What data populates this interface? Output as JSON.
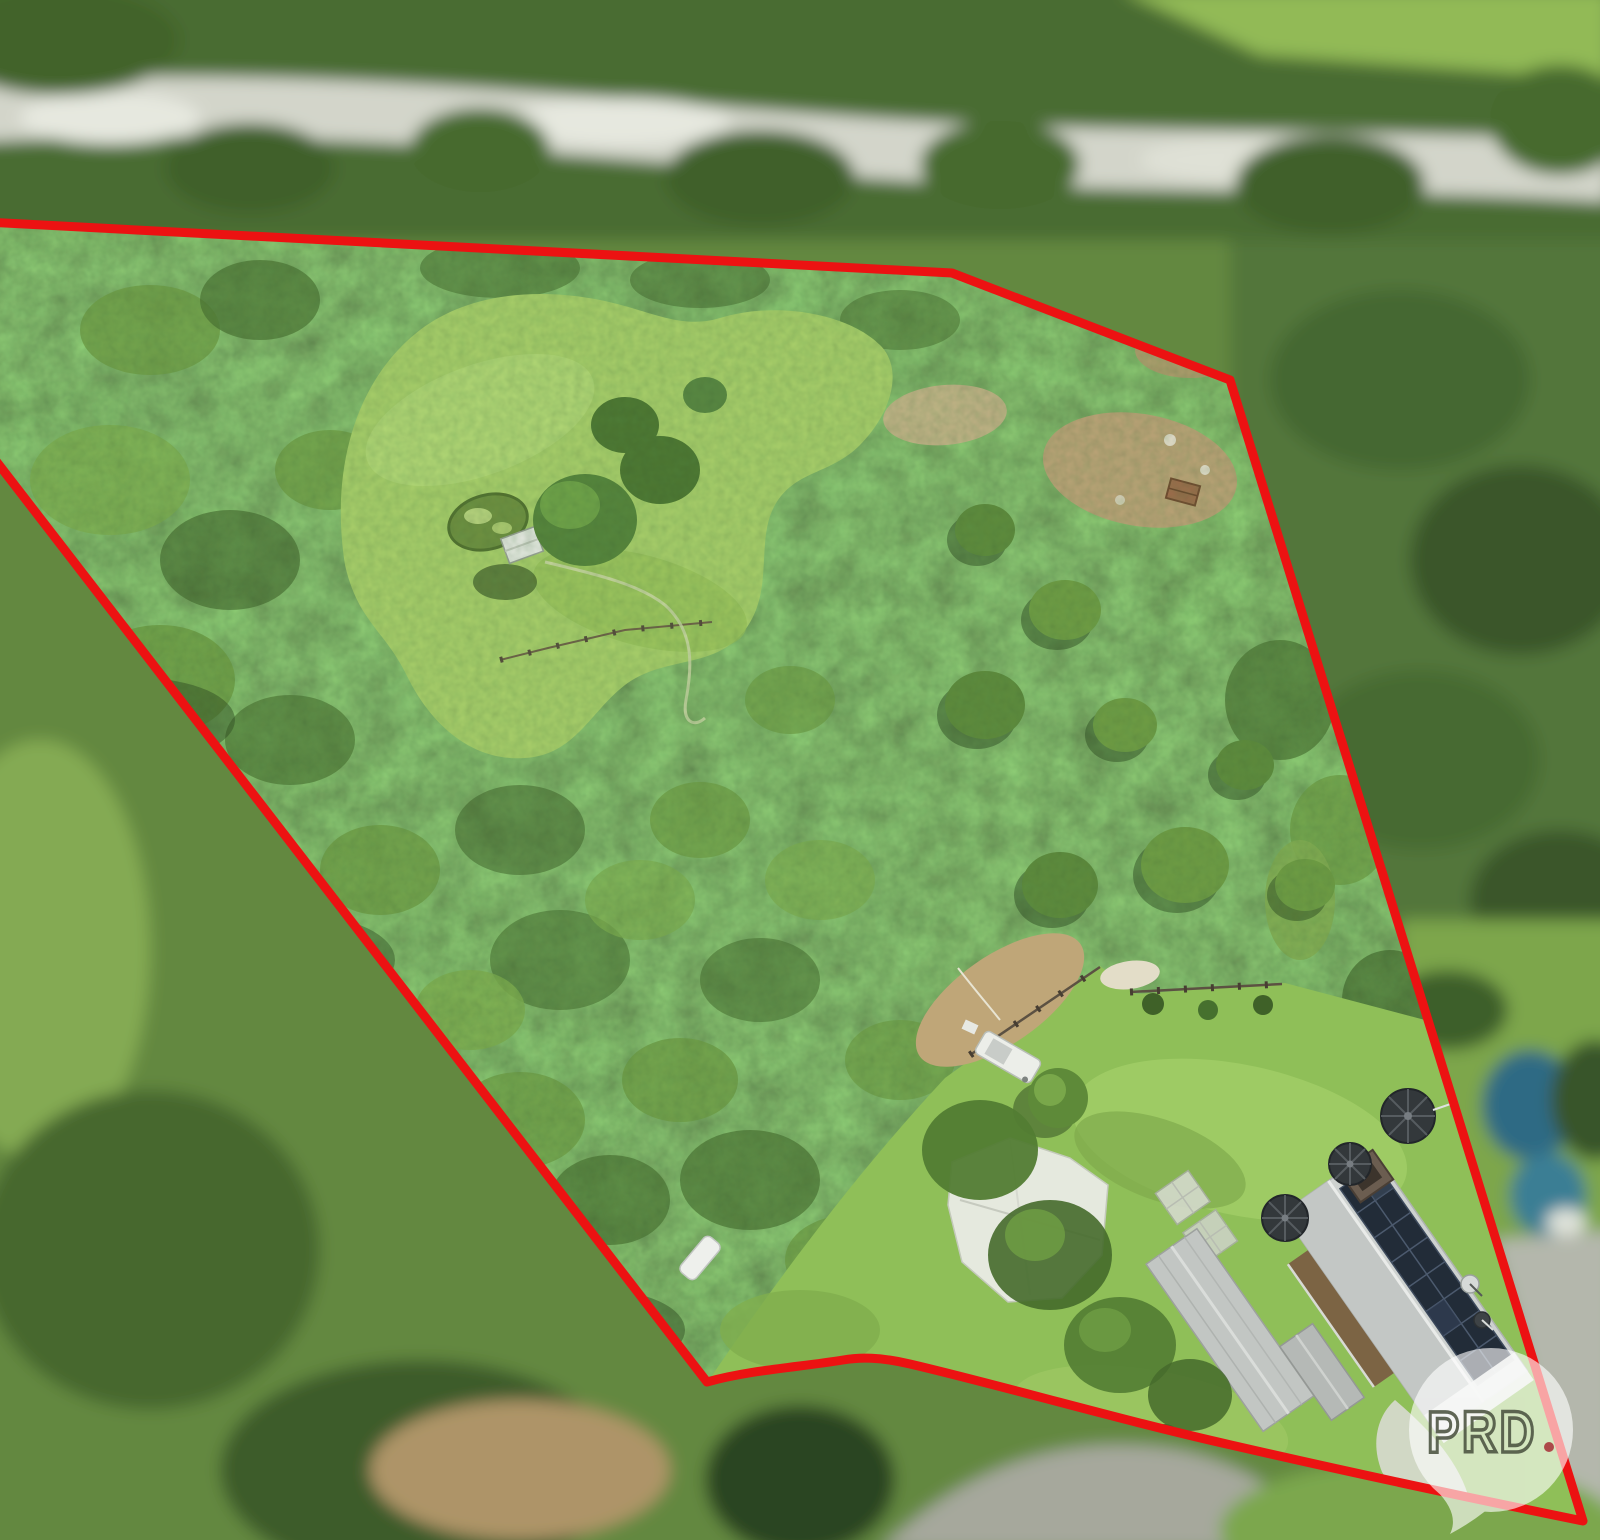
{
  "image": {
    "kind": "aerial-drone-photograph",
    "subject": "rural acreage property outlined in red with forest, cleared paddocks, house with rooftop solar, sheds and water tanks",
    "width_px": 1600,
    "height_px": 1540
  },
  "boundary": {
    "color": "#ec1212",
    "stroke_width": "9",
    "path_d": "M -14 222 L 952 273 L 1230 380 L 1583 1521 C 1470 1498 1340 1470 1231 1445 C 1120 1420 1000 1385 910 1364 C 880 1357 860 1357 843 1360 C 800 1367 750 1370 707 1382 L -14 448",
    "clip_d": "M -14 222 L 952 273 L 1230 380 L 1583 1521 C 1470 1498 1340 1470 1231 1445 C 1120 1420 1000 1385 910 1364 C 880 1357 860 1357 843 1360 C 800 1367 750 1370 707 1382 L -14 448 Z"
  },
  "watermark": {
    "text": "PRD",
    "bubble_color": "#ffffff",
    "bubble_opacity": "0.62",
    "letter_color": "#4b5340",
    "dot_color": "#a8343a"
  },
  "palette": {
    "focus_forest": "#57803a",
    "meadow_grass": "#a9cf6a",
    "lawn_grass": "#8fbf58",
    "dirt": "#bca377",
    "roof_gray": "#cdd1cf",
    "solar_panel": "#222c38",
    "blur_forest": "#4a6c30",
    "road_gray": "#d3d5ca",
    "pool_teal": "#2e6b84"
  },
  "features": {
    "inside_boundary": [
      "eucalyptus-forest",
      "grass-meadow",
      "pond",
      "garden-hut",
      "paddock-fence",
      "dirt-clearing",
      "lawn",
      "caravan",
      "shade-structure",
      "garden-beds",
      "sheds",
      "house-with-solar-panels",
      "water-tanks",
      "satellite-dishes",
      "driveway",
      "hedge-bushes"
    ],
    "outside_boundary": [
      "blurred-road",
      "blurred-forest",
      "neighbour-pool",
      "neighbour-driveway",
      "grass-field"
    ]
  }
}
